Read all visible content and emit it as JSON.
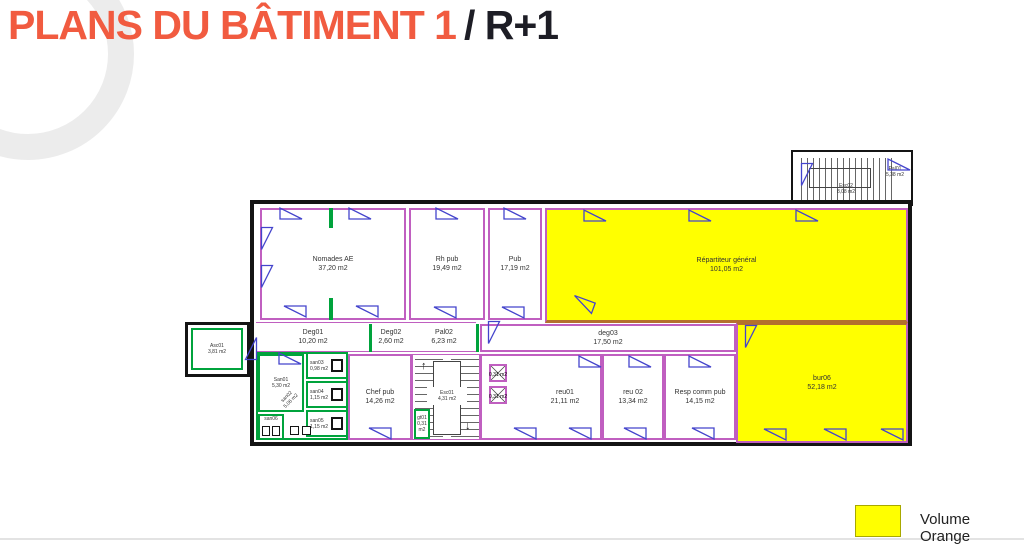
{
  "title": {
    "orange": "PLANS DU BÂTIMENT 1",
    "black": "/ R+1"
  },
  "legend": {
    "label": "Volume Orange",
    "swatch_color": "#ffff00"
  },
  "colors": {
    "accent_orange": "#f15b40",
    "highlight_yellow": "#ffff00",
    "wall_magenta": "#c05fc0",
    "door_blue": "#4444cc",
    "partition_green": "#00a33c",
    "separator_brown": "#b4702d"
  },
  "rooms": {
    "pal01": {
      "name": "Pal01",
      "area": "5,38 m2"
    },
    "esc02": {
      "name": "Esc02",
      "area": "8,08 m2"
    },
    "nomades": {
      "name": "Nomades AE",
      "area": "37,20 m2"
    },
    "rh_pub": {
      "name": "Rh pub",
      "area": "19,49 m2"
    },
    "pub": {
      "name": "Pub",
      "area": "17,19 m2"
    },
    "repartiteur": {
      "name": "Répartiteur général",
      "area": "101,05 m2"
    },
    "asc01": {
      "name": "Asc01",
      "area": "3,81 m2"
    },
    "deg01": {
      "name": "Deg01",
      "area": "10,20 m2"
    },
    "deg02": {
      "name": "Deg02",
      "area": "2,60 m2"
    },
    "pal02": {
      "name": "Pal02",
      "area": "6,23 m2"
    },
    "deg03": {
      "name": "deg03",
      "area": "17,50 m2"
    },
    "san01": {
      "name": "San01",
      "area": "5,30 m2"
    },
    "san02": {
      "name": "san02",
      "area": "5,06 m2"
    },
    "san03": {
      "name": "san03",
      "area": "0,98 m2"
    },
    "san04": {
      "name": "san04",
      "area": "1,15 m2"
    },
    "san05": {
      "name": "san05",
      "area": "1,15 m2"
    },
    "san06": {
      "name": "san06",
      "area": ""
    },
    "chef_pub": {
      "name": "Chef pub",
      "area": "14,26 m2"
    },
    "esc01": {
      "name": "Esc01",
      "area": "4,31 m2"
    },
    "reu01": {
      "name": "reu01",
      "area": "21,11 m2"
    },
    "reu02": {
      "name": "reu 02",
      "area": "13,34 m2"
    },
    "resp_comm": {
      "name": "Resp comm pub",
      "area": "14,15 m2"
    },
    "bur06": {
      "name": "bur06",
      "area": "52,18 m2"
    },
    "gt01": {
      "name": "gt01",
      "area": "0,31 m2"
    },
    "gaine_top": {
      "area": "0,31 m2"
    },
    "gaine_bottom": {
      "area": "0,31 m2"
    }
  }
}
